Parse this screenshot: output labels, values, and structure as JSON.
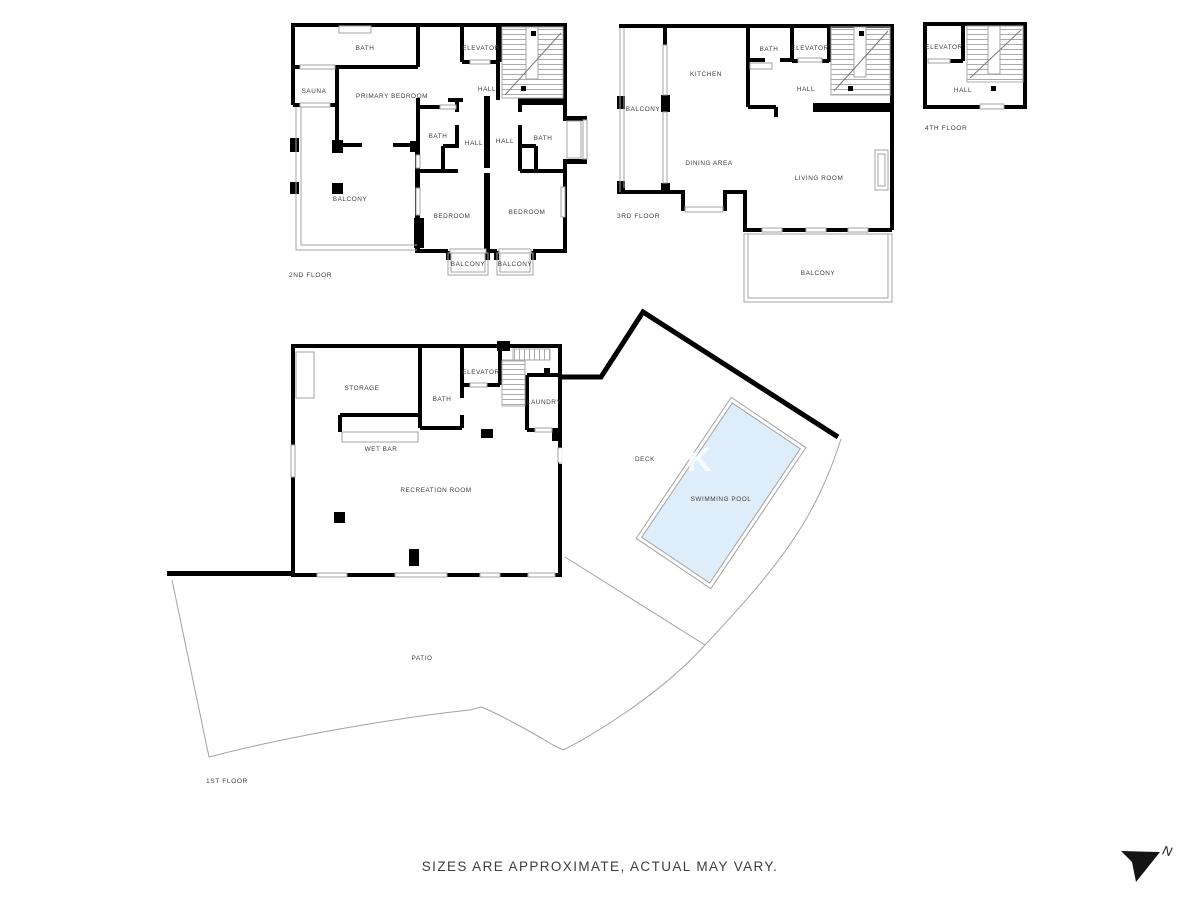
{
  "disclaimer": "SIZES ARE APPROXIMATE, ACTUAL MAY VARY.",
  "compass": {
    "north_label": "N"
  },
  "watermark": "K",
  "colors": {
    "wall": "#000000",
    "thin_line": "#a3a3a3",
    "label": "#3d3d3d",
    "pool_fill": "#ddedf9"
  },
  "floors": [
    {
      "name": "2ND FLOOR",
      "rooms": [
        {
          "label": "BATH"
        },
        {
          "label": "SAUNA"
        },
        {
          "label": "PRIMARY BEDROOM"
        },
        {
          "label": "ELEVATOR"
        },
        {
          "label": "HALL"
        },
        {
          "label": "BATH"
        },
        {
          "label": "HALL"
        },
        {
          "label": "HALL"
        },
        {
          "label": "BATH"
        },
        {
          "label": "BALCONY"
        },
        {
          "label": "BEDROOM"
        },
        {
          "label": "BEDROOM"
        },
        {
          "label": "BALCONY"
        },
        {
          "label": "BALCONY"
        }
      ]
    },
    {
      "name": "3RD FLOOR",
      "rooms": [
        {
          "label": "BALCONY"
        },
        {
          "label": "KITCHEN"
        },
        {
          "label": "BATH"
        },
        {
          "label": "ELEVATOR"
        },
        {
          "label": "HALL"
        },
        {
          "label": "DINING AREA"
        },
        {
          "label": "LIVING ROOM"
        },
        {
          "label": "BALCONY"
        }
      ]
    },
    {
      "name": "4TH FLOOR",
      "rooms": [
        {
          "label": "ELEVATOR"
        },
        {
          "label": "HALL"
        }
      ]
    },
    {
      "name": "1ST FLOOR",
      "rooms": [
        {
          "label": "STORAGE"
        },
        {
          "label": "BATH"
        },
        {
          "label": "ELEVATOR"
        },
        {
          "label": "LAUNDRY"
        },
        {
          "label": "WET BAR"
        },
        {
          "label": "RECREATION ROOM"
        },
        {
          "label": "DECK"
        },
        {
          "label": "SWIMMING POOL"
        },
        {
          "label": "PATIO"
        }
      ]
    }
  ]
}
